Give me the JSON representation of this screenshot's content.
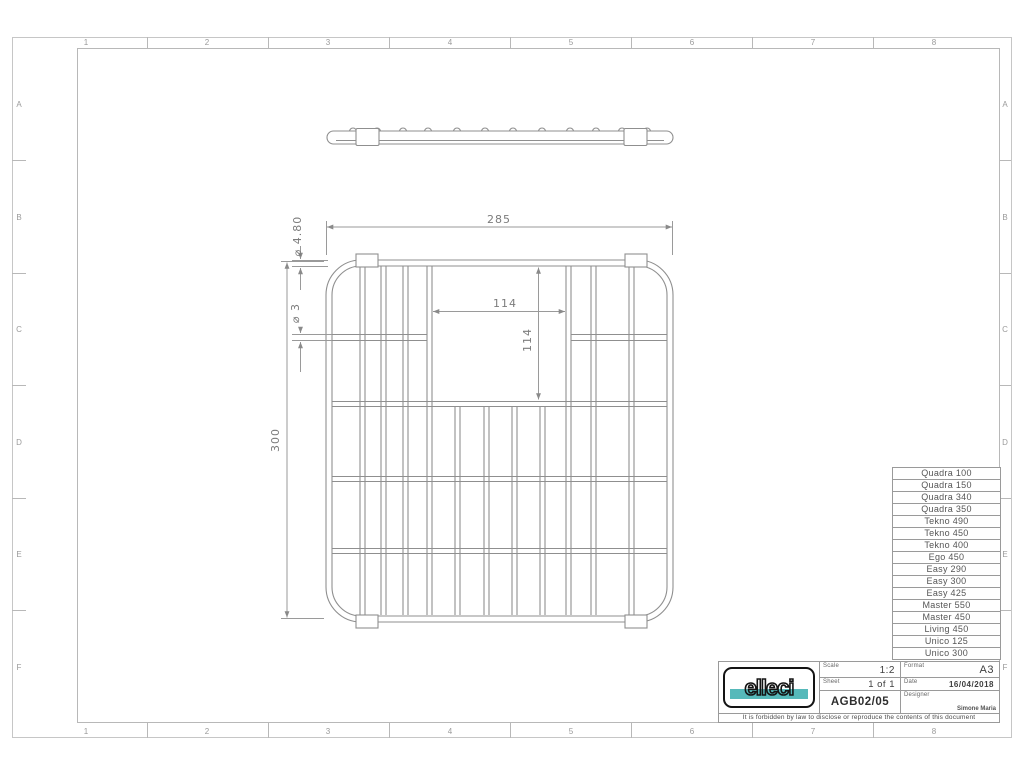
{
  "sheet": {
    "zones": {
      "cols": [
        "1",
        "2",
        "3",
        "4",
        "5",
        "6",
        "7",
        "8"
      ],
      "rows": [
        "A",
        "B",
        "C",
        "D",
        "E",
        "F"
      ]
    }
  },
  "drawing": {
    "dims": {
      "overall_width": "285",
      "overall_height": "300",
      "cutout_width": "114",
      "cutout_height": "114",
      "frame_wire_dia": "⌀ 4.80",
      "grid_wire_dia": "⌀ 3"
    }
  },
  "model_table": {
    "rows": [
      "Quadra 100",
      "Quadra 150",
      "Quadra 340",
      "Quadra 350",
      "Tekno 490",
      "Tekno 450",
      "Tekno 400",
      "Ego 450",
      "Easy 290",
      "Easy 300",
      "Easy 425",
      "Master 550",
      "Master 450",
      "Living 450",
      "Unico 125",
      "Unico 300"
    ]
  },
  "title_block": {
    "brand": "elleci",
    "scale_label": "Scale",
    "scale_value": "1:2",
    "sheet_label": "Sheet",
    "sheet_value": "1 of 1",
    "format_label": "Format",
    "format_value": "A3",
    "date_label": "Date",
    "date_value": "16/04/2018",
    "designer_label": "Designer",
    "designer_value": "Simone Maria",
    "drawing_code": "AGB02/05",
    "legal_notice": "It is forbidden by law to disclose or reproduce the contents of this document"
  },
  "colors": {
    "brand_accent": "#56b9ba",
    "drawing_line": "#8f8f8f"
  }
}
